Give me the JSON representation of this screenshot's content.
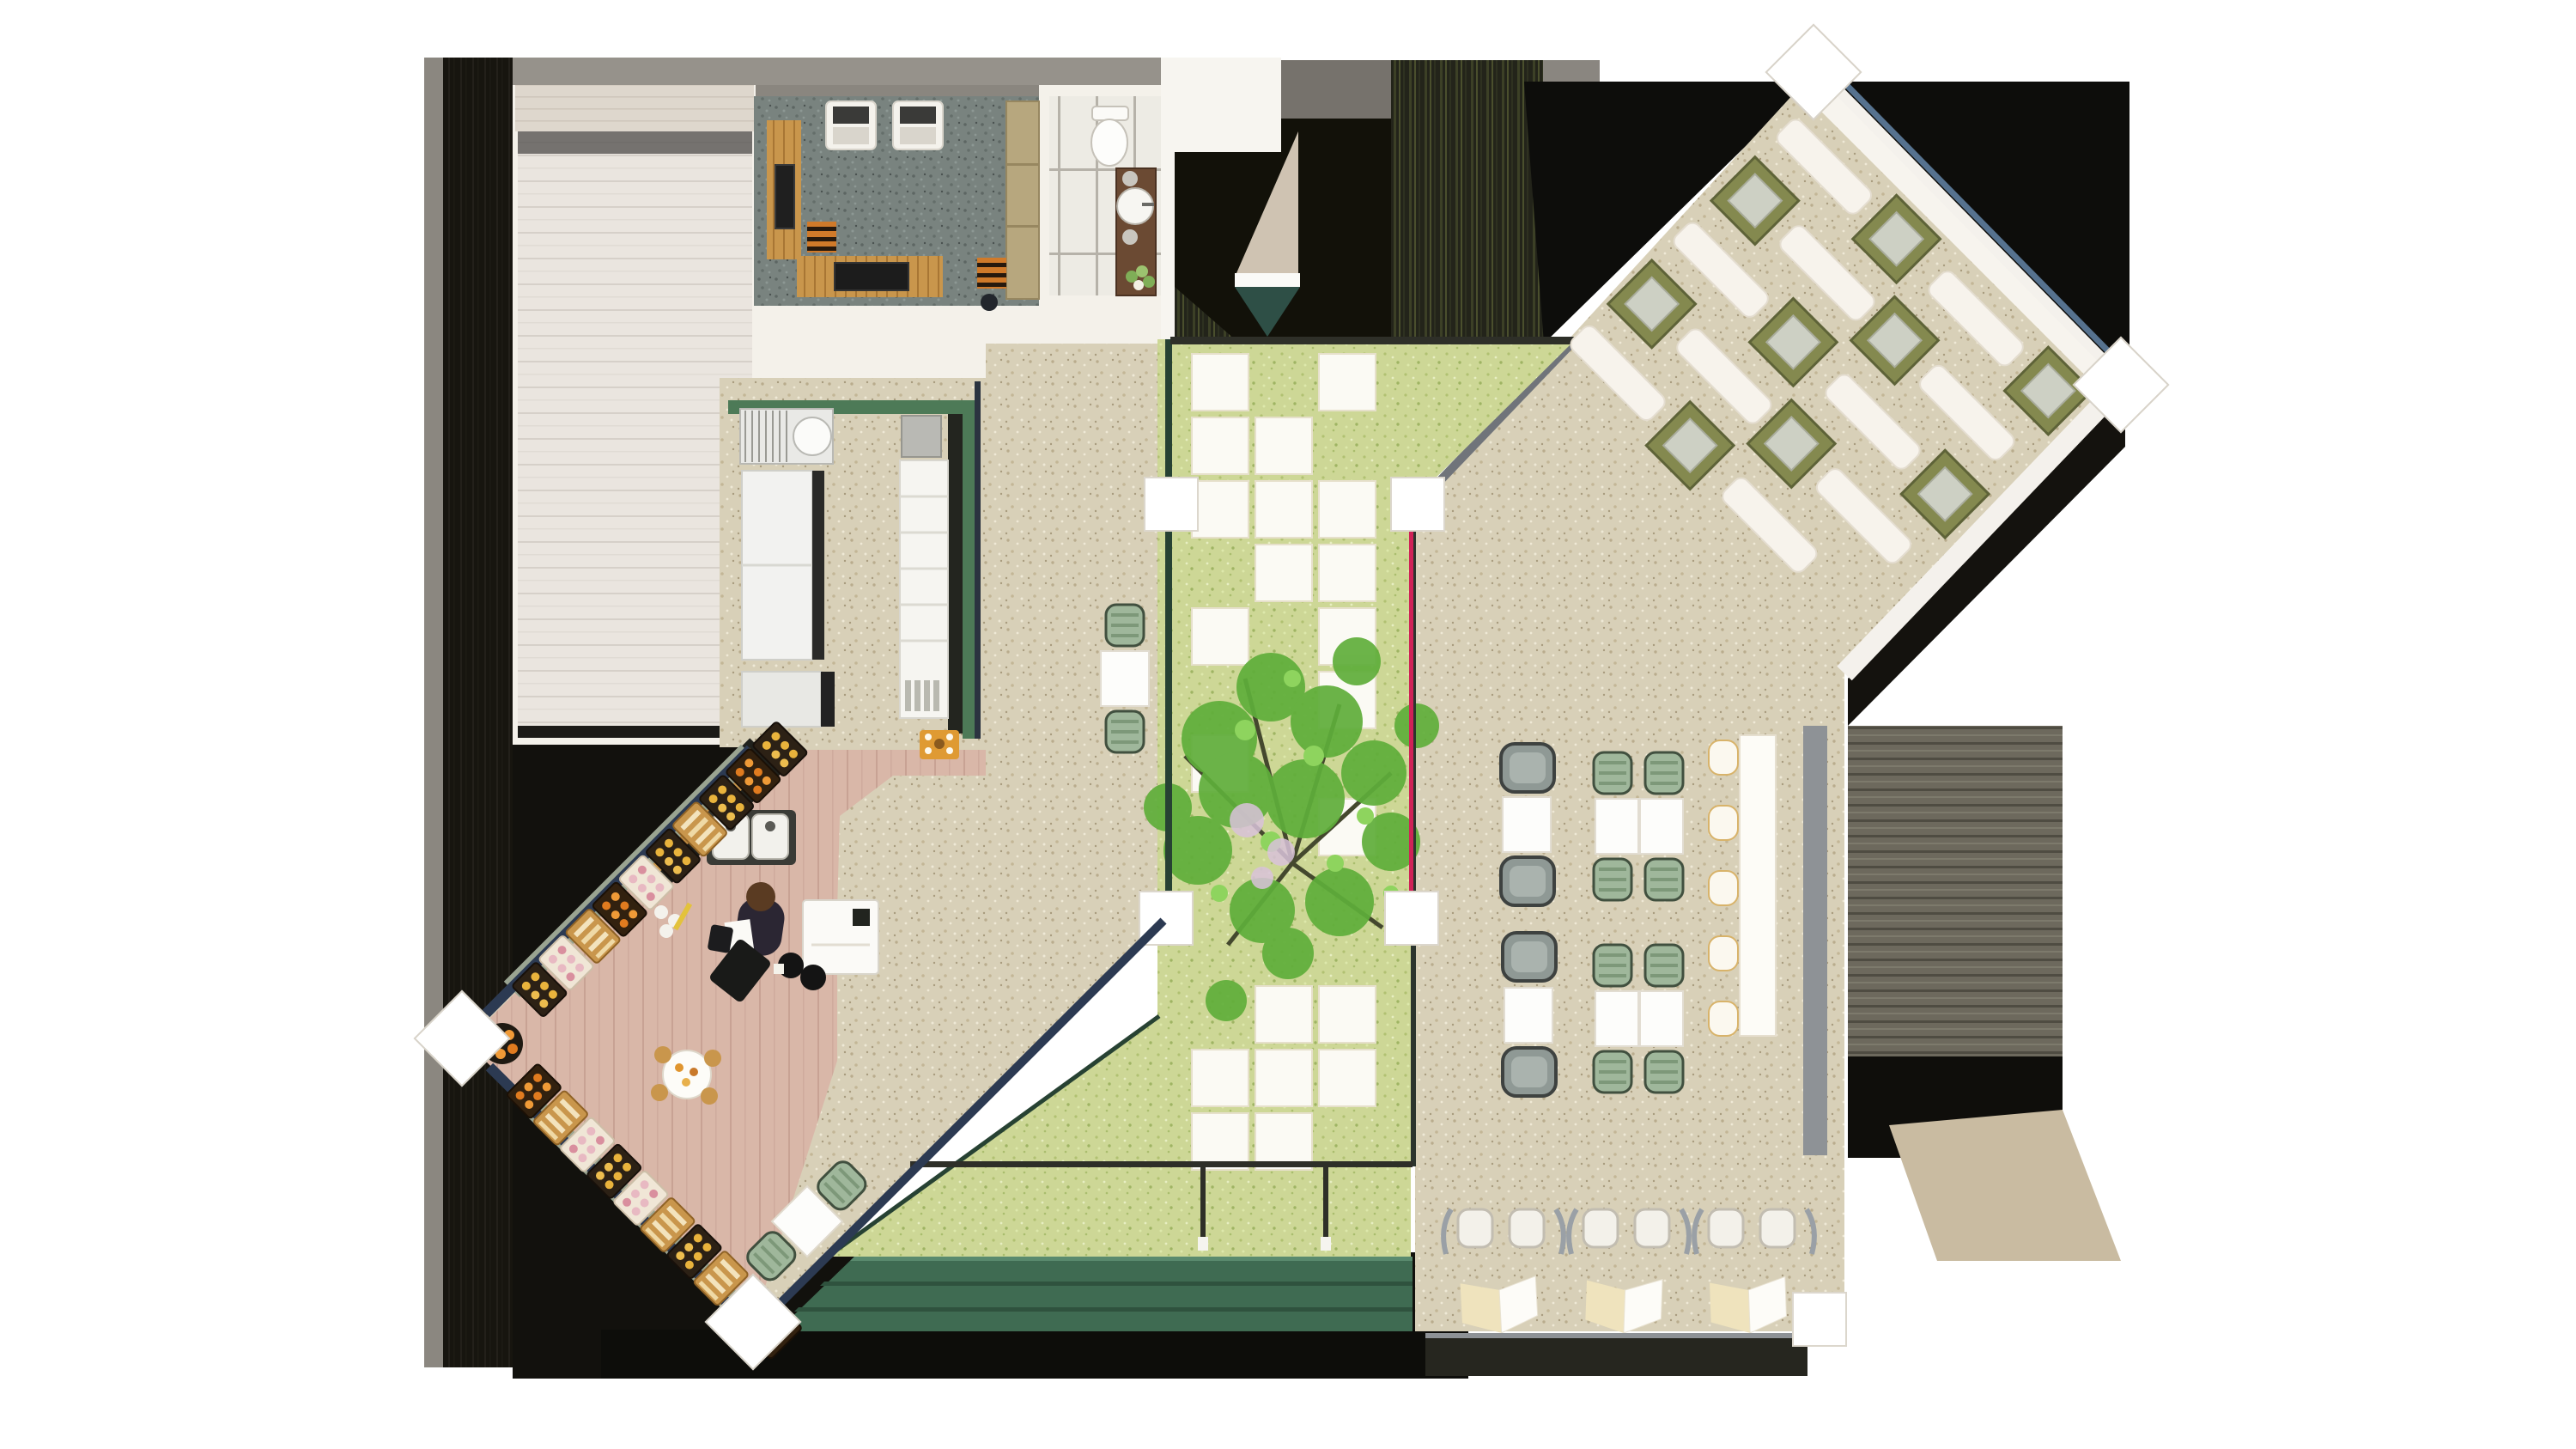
{
  "scene": {
    "kind": "architectural-floor-plan-render",
    "view": "top-down",
    "setting": "cafe-bakery-with-courtyard",
    "has_text": false
  },
  "palette": {
    "page_bg": "#ffffff",
    "shadow_black": "#12110d",
    "shadow_gray_strip": "#8b8780",
    "roof_gray": "#96928b",
    "wall_white": "#f4f1ea",
    "plank_floor": "#eae5df",
    "deck_band": "#ded7cd",
    "rug_gray": "#79837f",
    "tile_white": "#edebe4",
    "speckle_beige": "#d8d0b8",
    "grass_green": "#cdd796",
    "paver_white": "#fbfaf4",
    "hedge_dark_olive": "#23241a",
    "teal_triangle": "#2e4f46",
    "kitchen_wall_green": "#4d7a57",
    "pink_wood_floor": "#d9b7a8",
    "navy_wall": "#2c3a52",
    "stone_band": "#9aa491",
    "accent_magenta": "#cf2257",
    "courtyard_rail": "#2e2f28",
    "louver_green": "#3f6b52",
    "olive_table": "#84894f",
    "cushion_gray": "#cdd0c4",
    "sage_chair": "#9fb79b",
    "gray_chair": "#8f9995",
    "wood_orange": "#c08a42",
    "espresso_machine_orange": "#df9a33",
    "louver_shadow": "#6d695d",
    "tan_wedge": "#c9bba1",
    "glass_blue": "#56728f",
    "tree_leaf_dark": "#5fae3a",
    "tree_leaf_light": "#8ed45e",
    "tree_branch": "#44482e",
    "blossom_pink": "#d9c3da"
  },
  "zones": [
    {
      "id": "plank-room",
      "purpose": "service-room-plank-floor"
    },
    {
      "id": "lounge-room",
      "purpose": "lounge-with-rug-armchairs"
    },
    {
      "id": "bathroom",
      "purpose": "wc-with-toilet-sink-vanity"
    },
    {
      "id": "kitchen",
      "purpose": "galley-kitchen-green-walls"
    },
    {
      "id": "coffee-bar",
      "purpose": "barista-counter-pink-floor"
    },
    {
      "id": "pastry-corner",
      "purpose": "bakery-display-trays"
    },
    {
      "id": "courtyard",
      "purpose": "grass-garden-pavers-tree"
    },
    {
      "id": "dining-hall",
      "purpose": "tables-chairs-counter"
    },
    {
      "id": "banquette-wing",
      "purpose": "rotated-booth-seating"
    },
    {
      "id": "terrace",
      "purpose": "outdoor-two-top"
    },
    {
      "id": "entry-shadow",
      "purpose": "shaded-entrance-hedges"
    }
  ],
  "furniture_inventory": {
    "lounge_armchairs": 2,
    "striped_poufs": 2,
    "courtyard_pavers": 21,
    "courtyard_trees": 1,
    "path_two_top_tables": 1,
    "dining_gray_two_tops": 2,
    "dining_sage_four_tops": 2,
    "counter_stools": 5,
    "bar_chair_pairs": 3,
    "chevron_bar_tables": 3,
    "banquette_tables": 9,
    "banquette_benches": 10,
    "pastry_trays": 20,
    "terrace_chairs": 2,
    "white_columns_square": 4,
    "white_columns_diamond": 4,
    "customer_bar_seats": 2,
    "staff_figures": 1
  }
}
